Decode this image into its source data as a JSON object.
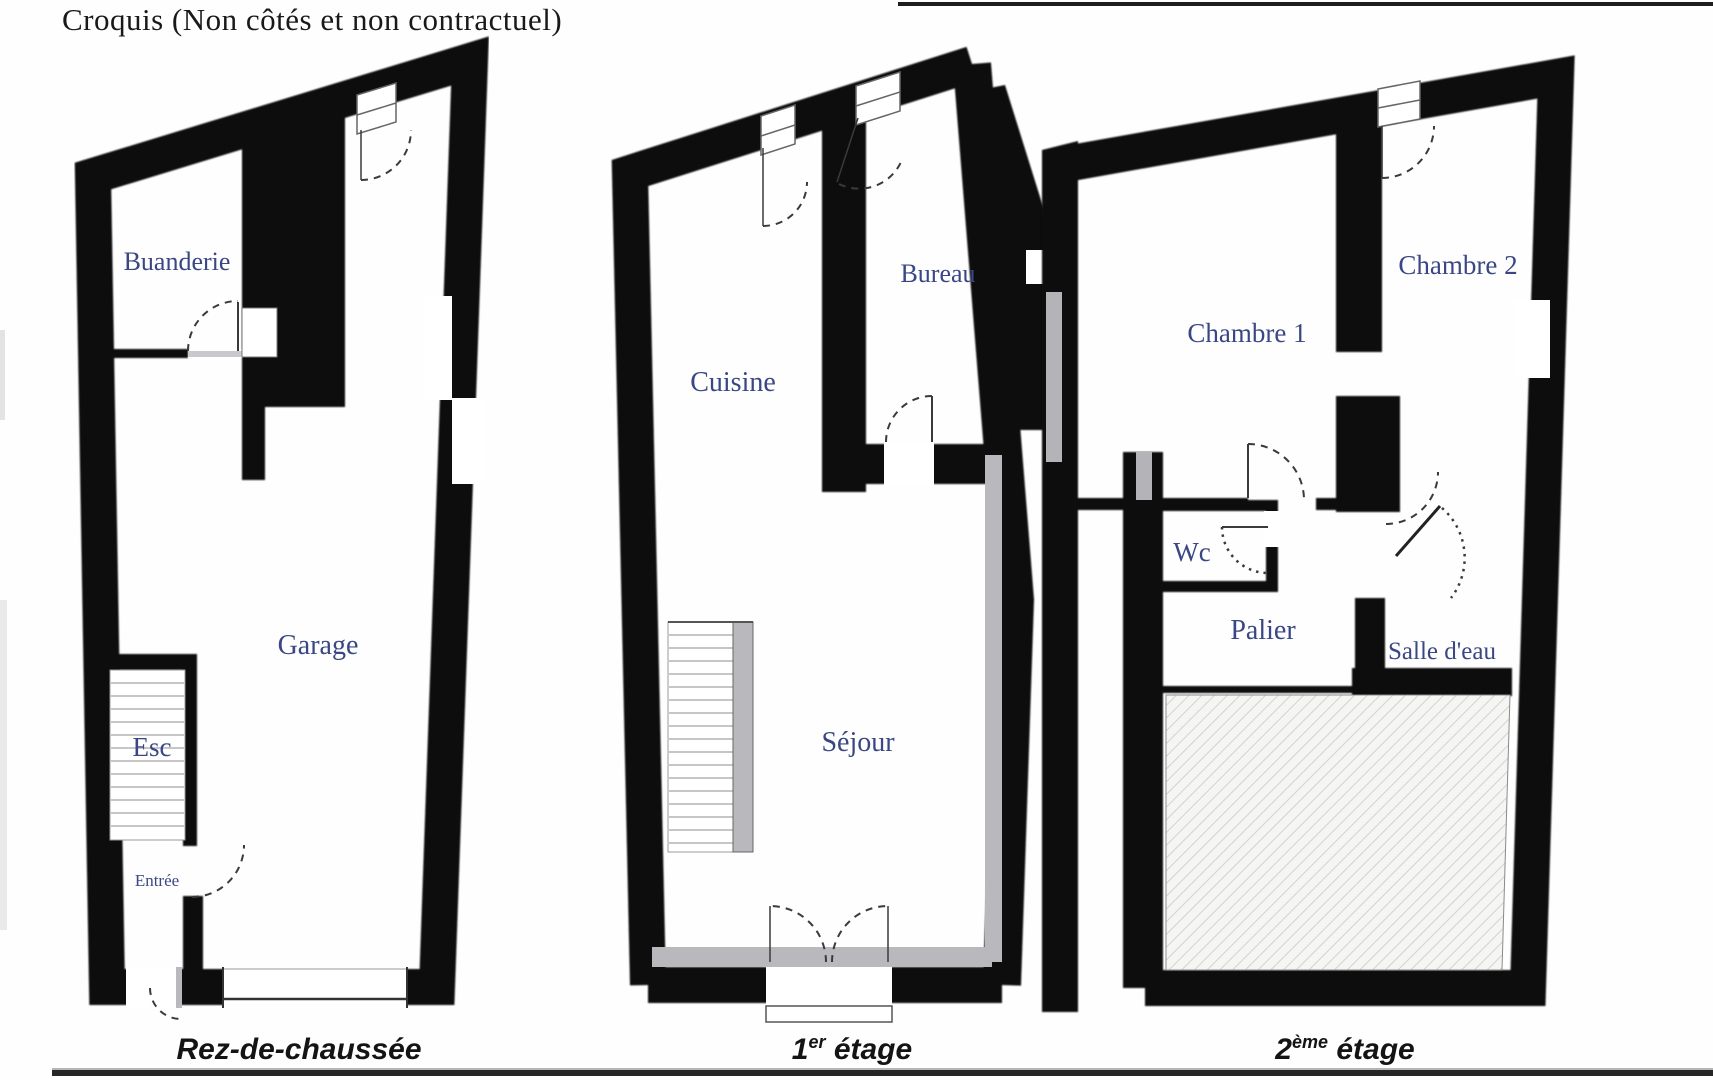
{
  "title": "Croquis (Non côtés et non contractuel)",
  "colors": {
    "wall": "#0d0d0d",
    "room_label": "#3a4784",
    "floor_label": "#141414",
    "gray_fitting": "#b9b9bd",
    "hatch_line": "#c9c9c5"
  },
  "plans": [
    {
      "floor": {
        "prefix": "Rez-de-chaussée",
        "sup": "",
        "suffix": ""
      },
      "rooms": {
        "buanderie": "Buanderie",
        "garage": "Garage",
        "esc": "Esc",
        "entree": "Entrée"
      }
    },
    {
      "floor": {
        "prefix": "1",
        "sup": "er",
        "suffix": " étage"
      },
      "rooms": {
        "cuisine": "Cuisine",
        "bureau": "Bureau",
        "sejour": "Séjour"
      }
    },
    {
      "floor": {
        "prefix": "2",
        "sup": "ème",
        "suffix": " étage"
      },
      "rooms": {
        "chambre1": "Chambre 1",
        "chambre2": "Chambre 2",
        "wc": "Wc",
        "palier": "Palier",
        "salle_deau": "Salle d'eau"
      }
    }
  ]
}
